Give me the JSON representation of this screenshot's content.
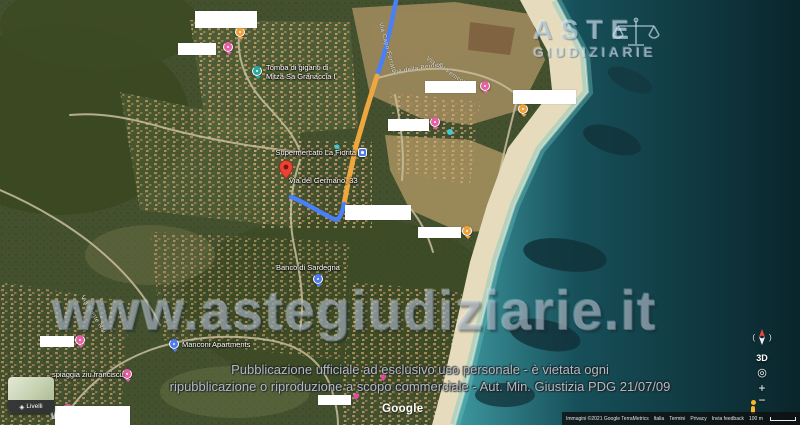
{
  "watermark": {
    "text": "www.astegiudiziarie.it",
    "fragment": "W"
  },
  "logo": {
    "line1": "ASTE",
    "line2": "GIUDIZIARIE"
  },
  "disclaimer": {
    "line1": "Pubblicazione ufficiale ad esclusivo uso personale - è vietata ogni",
    "line2": "ripubblicazione o riproduzione a scopo commerciale - Aut. Min. Giustizia PDG 21/07/09"
  },
  "map_labels": [
    {
      "text": "Tomba di giganti di"
    },
    {
      "text": "Mitza Sa Granaccia I"
    },
    {
      "text": "Supermercato La Fiorita"
    },
    {
      "text": "Via del Germano, 33"
    },
    {
      "text": "Banco di Sardegna"
    },
    {
      "text": "Manconi Apartments"
    },
    {
      "text": "spiaggia ziu franciscu"
    },
    {
      "text": "Via Capo Ferrato"
    },
    {
      "text": "Via della Pernice"
    },
    {
      "text": "Via Monte Nai"
    },
    {
      "text": "Via del Fenicottero"
    }
  ],
  "controls": {
    "three_d": "3D",
    "target_icon": "◎",
    "zoom_in": "+",
    "zoom_out": "−",
    "layers_icon": "◈",
    "layers_label": "Livelli"
  },
  "google_logo": "Google",
  "attribution": {
    "credits": "Immagini ©2021 Google TerraMetrics,Immagini ©2021 CNES / Airbus,Maxar Technologies,Dati cartografici ©2021",
    "country": "Italia",
    "terms": "Termini",
    "privacy": "Privacy",
    "feedback": "Invia feedback",
    "scale": "100 m"
  },
  "icons": {
    "heart": "♥",
    "compass_left": "(",
    "compass_right": ")"
  },
  "colors": {
    "route_blue": "#4a80f5",
    "route_orange": "#eda73e",
    "poi_pink": "#e85fa2",
    "poi_teal": "#2ba89f",
    "poi_orange": "#f0a13b",
    "poi_blue": "#4e7bf0",
    "pin_red": "#ea4335",
    "heart_pink": "#f43ea6"
  }
}
